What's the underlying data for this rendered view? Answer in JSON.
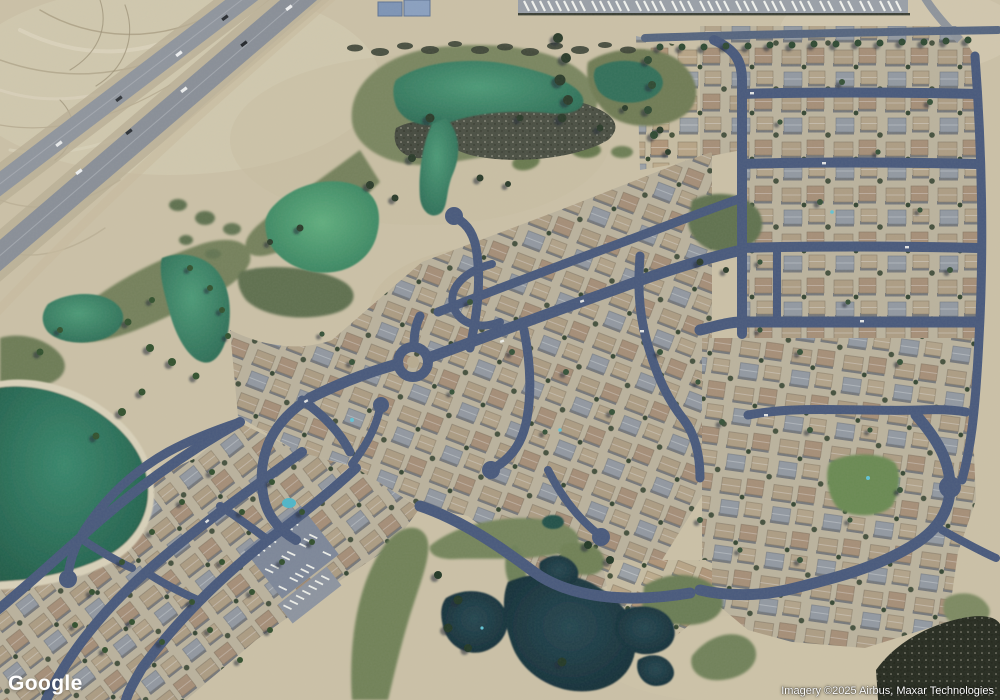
{
  "map": {
    "view_type": "satellite-imagery",
    "scene": "Aerial view of a desert golf-course residential community: divided highway at upper left, teal golf ponds and a lake, olive fairways, dense curvilinear streets with tan-roofed houses, RV/boat storage lots along the top, dark water hazards along the bottom golf corridor",
    "features": [
      "highway",
      "desert",
      "golf-fairways",
      "ponds",
      "lake",
      "residential-grid",
      "roundabout",
      "cul-de-sacs",
      "parking-lots",
      "clubhouse-pool",
      "park",
      "trees"
    ]
  },
  "watermarks": {
    "google_logo": "Google",
    "attribution": "Imagery ©2025 Airbus, Maxar Technologies"
  },
  "palette": {
    "desert": "#cbc1a7",
    "desert_light": "#d8d0ba",
    "highway_gray": "#8e949c",
    "street_blue": "#48597c",
    "fairway_olive": "#75825b",
    "pond_teal": "#3d8a6e",
    "pond_bright": "#55a877",
    "pond_dark": "#1d3b43",
    "roof_tan": "#b7a486",
    "roof_brown": "#af9579",
    "roof_gray": "#9aa0a6",
    "tree_green": "#2f4a33"
  }
}
